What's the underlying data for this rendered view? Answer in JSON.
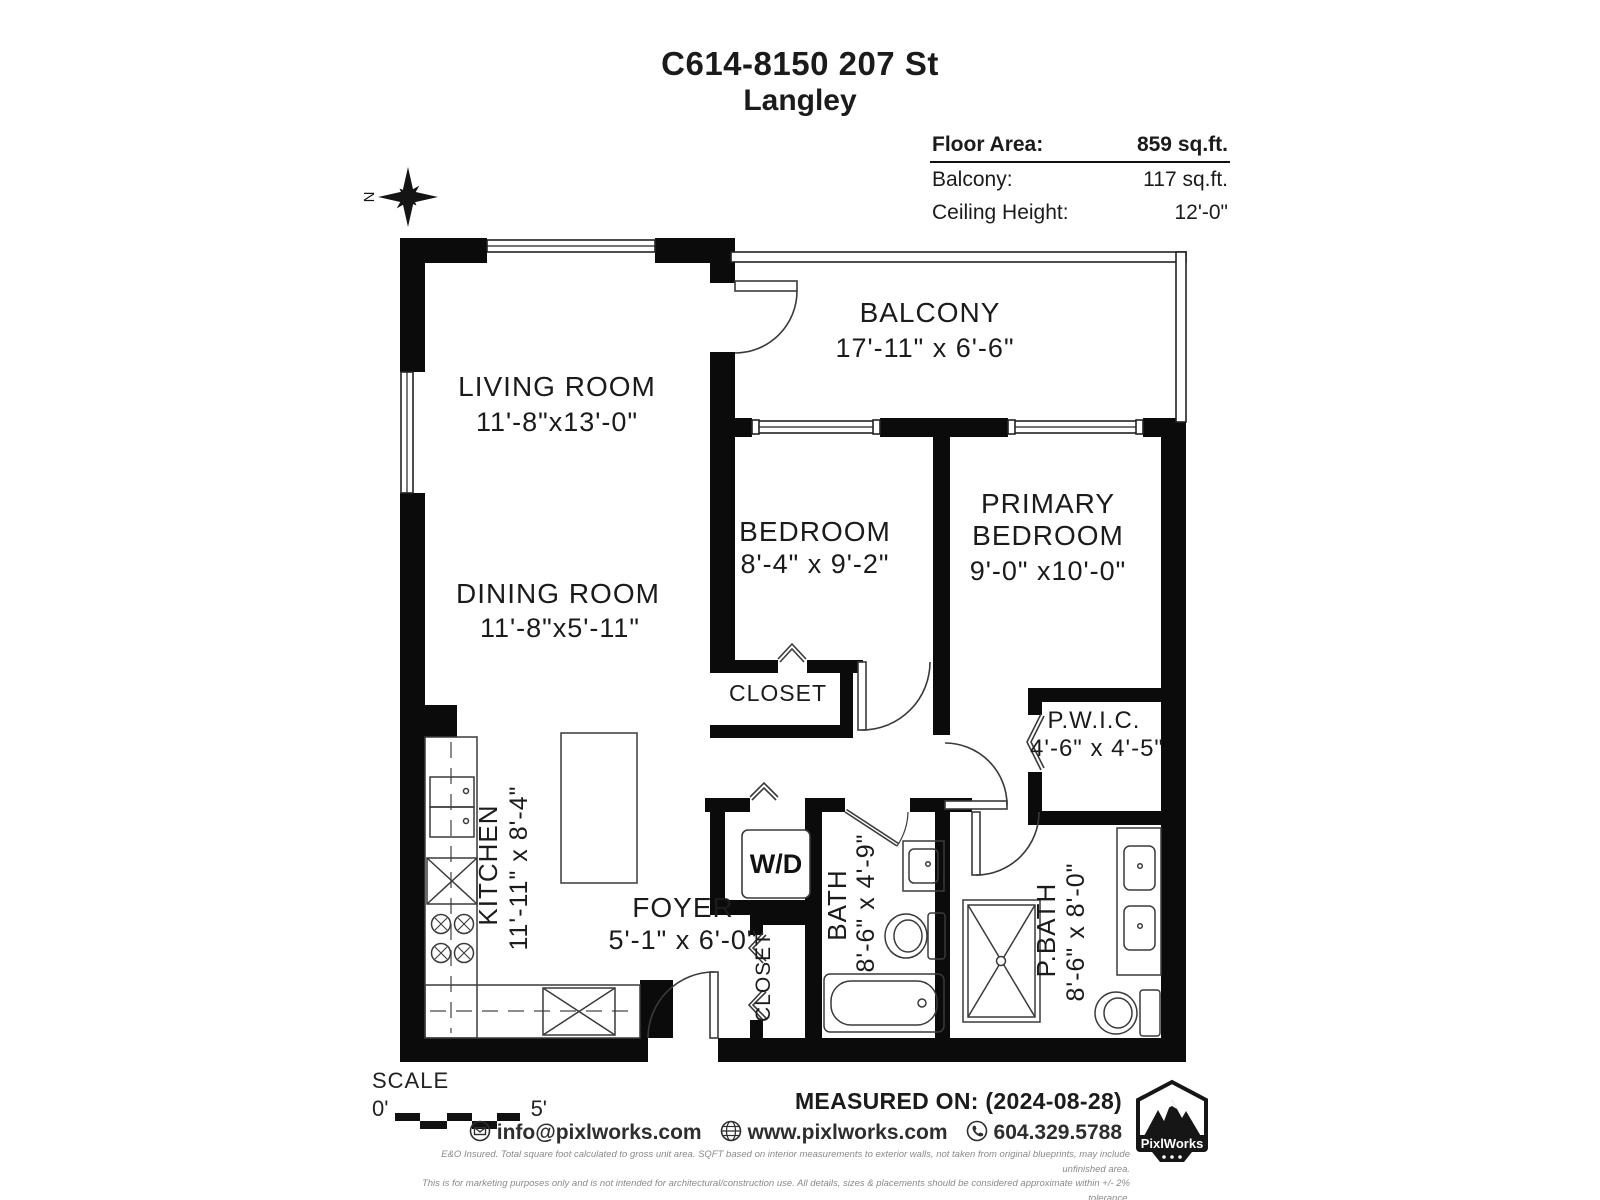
{
  "title": {
    "line1": "C614-8150 207 St",
    "line2": "Langley"
  },
  "info_table": {
    "rows": [
      {
        "label": "Floor Area:",
        "value": "859 sq.ft."
      },
      {
        "label": "Balcony:",
        "value": "117 sq.ft."
      },
      {
        "label": "Ceiling Height:",
        "value": "12'-0\""
      }
    ]
  },
  "compass": {
    "north_label": "N"
  },
  "rooms": {
    "balcony": {
      "name": "BALCONY",
      "dims": "17'-11\" x  6'-6\""
    },
    "living": {
      "name": "LIVING ROOM",
      "dims": "11'-8\"x13'-0\""
    },
    "dining": {
      "name": "DINING ROOM",
      "dims": "11'-8\"x5'-11\""
    },
    "bedroom": {
      "name": "BEDROOM",
      "dims": "8'-4\" x 9'-2\""
    },
    "primary": {
      "name_line1": "PRIMARY",
      "name_line2": "BEDROOM",
      "dims": "9'-0\" x10'-0\""
    },
    "closet_bedroom": {
      "name": "CLOSET"
    },
    "pwic": {
      "name": "P.W.I.C.",
      "dims": "4'-6\" x 4'-5\""
    },
    "kitchen": {
      "name": "KITCHEN",
      "dims": "11'-11\" x 8'-4\""
    },
    "wd": {
      "name": "W/D"
    },
    "foyer": {
      "name": "FOYER",
      "dims": "5'-1\" x 6'-0\""
    },
    "closet_foyer": {
      "name": "CLOSET"
    },
    "bath": {
      "name": "BATH",
      "dims": "8'-6\" x 4'-9\""
    },
    "pbath": {
      "name": "P.BATH",
      "dims": "8'-6\" x 8'-0\""
    }
  },
  "scale": {
    "label": "SCALE",
    "start": "0'",
    "end": "5'"
  },
  "footer": {
    "measured_on": "MEASURED ON: (2024-08-28)",
    "email": "info@pixlworks.com",
    "website": "www.pixlworks.com",
    "phone": "604.329.5788",
    "logo_text": "PixlWorks",
    "disclaimer1": "E&O Insured.  Total square foot calculated to gross unit area. SQFT based on interior measurements to exterior walls, not taken from original blueprints, may include unfinished area.",
    "disclaimer2": "This is for marketing purposes only and is not intended for architectural/construction use.  All details, sizes & placements should be considered approximate within +/- 2%  tolerance."
  },
  "colors": {
    "wall": "#0b0b0b",
    "line": "#333333",
    "text": "#1b1b1b"
  }
}
